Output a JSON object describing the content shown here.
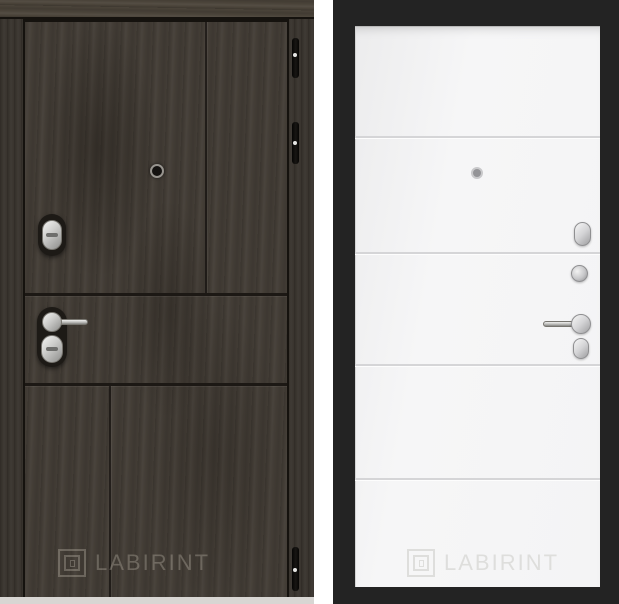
{
  "watermarks": {
    "left": "LABIRINT",
    "right": "LABIRINT"
  },
  "left_door": {
    "side": "exterior",
    "colors": {
      "wood": "#433d36",
      "frame": "#39342e",
      "lintel": "#4b443a",
      "gap_line": "#15120e",
      "chrome_hardware": "#c9c9c9",
      "hinge": "#0d0c0a",
      "watermark": "rgba(222,214,202,0.28)",
      "floor": "#d8d6d3"
    }
  },
  "right_door": {
    "side": "interior",
    "colors": {
      "frame": "#232323",
      "leaf": "#f5f5f6",
      "groove": "#d5d5d7",
      "chrome_hardware": "#c6c6c8",
      "watermark": "#dededc"
    }
  }
}
